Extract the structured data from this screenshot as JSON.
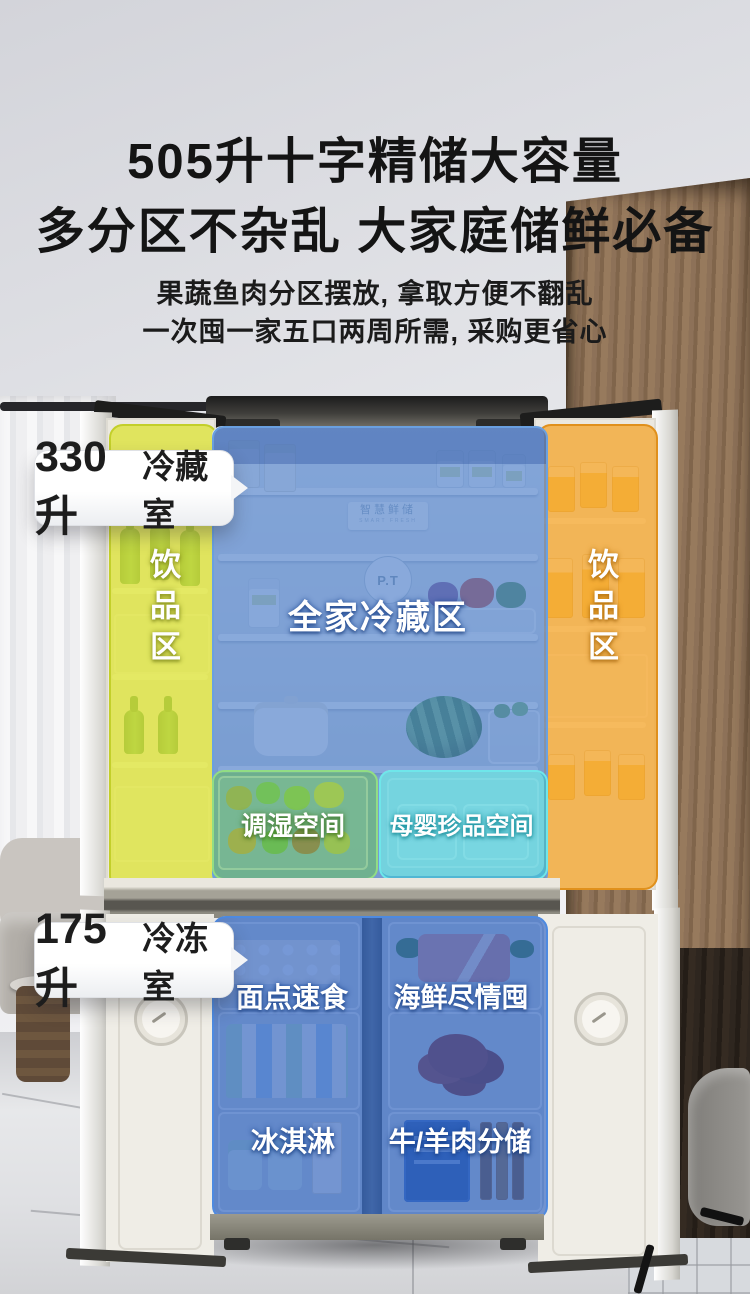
{
  "header": {
    "title_line1": "505升十字精储大容量",
    "title_line2": "多分区不杂乱 大家庭储鲜必备",
    "subtitle_line1": "果蔬鱼肉分区摆放, 拿取方便不翻乱",
    "subtitle_line2": "一次囤一家五口两周所需, 采购更省心"
  },
  "callouts": {
    "fridge": {
      "value": "330升",
      "suffix": "冷藏室"
    },
    "freezer": {
      "value": "175升",
      "suffix": "冷冻室"
    }
  },
  "zones": {
    "left_drink": {
      "label": "饮品区",
      "color": "#dde33a"
    },
    "right_drink": {
      "label": "饮品区",
      "color": "#f3a631"
    },
    "family_cold": {
      "label": "全家冷藏区",
      "color": "#5282ca"
    },
    "humidity": {
      "label": "调湿空间",
      "color": "#6ac066"
    },
    "mother_baby": {
      "label": "母婴珍品空间",
      "color": "#3ac8d6"
    },
    "freezer_color": "#3064c3",
    "freezer_cells": [
      {
        "label": "面点速食"
      },
      {
        "label": "海鲜尽情囤"
      },
      {
        "label": "冰淇淋"
      },
      {
        "label": "牛/羊肉分储"
      }
    ]
  },
  "interior": {
    "brand_board": "智慧鲜储",
    "brand_board_sub": "SMART FRESH",
    "logo_badge": "P.T"
  }
}
